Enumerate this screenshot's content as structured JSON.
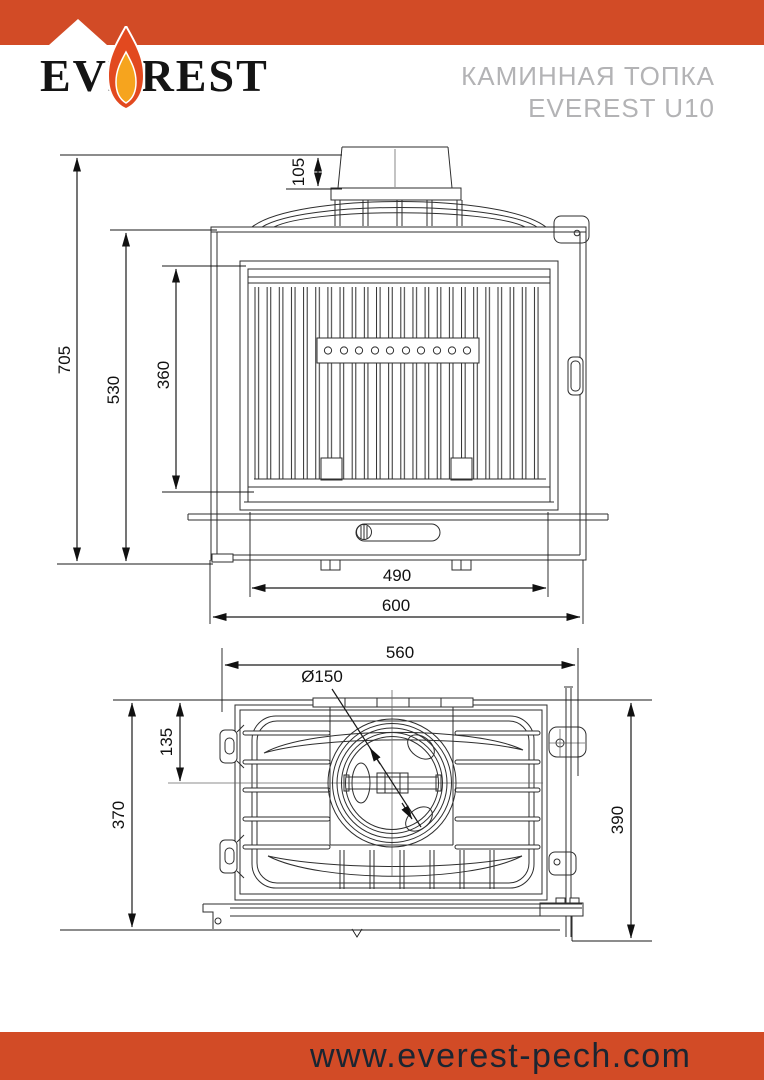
{
  "header": {
    "logo_text": "EVEREST",
    "product_title_line1": "КАМИННАЯ ТОПКА",
    "product_title_line2": "EVEREST U10"
  },
  "footer": {
    "website": "www.everest-pech.com"
  },
  "colors": {
    "accent_orange": "#d24b26",
    "drawing_line": "#2e2e2e",
    "title_gray": "#b3b3b5",
    "footer_text": "#1b2531",
    "flame_outer": "#e2491f",
    "flame_inner": "#f6a41e"
  },
  "front_view": {
    "dimensions": {
      "flue_collar_height": "105",
      "total_height": "705",
      "body_height": "530",
      "glass_height": "360",
      "inner_width": "490",
      "total_width": "600"
    }
  },
  "top_view": {
    "dimensions": {
      "total_width": "560",
      "flue_diameter": "Ø150",
      "flue_center_offset": "135",
      "body_depth": "370",
      "total_depth": "390"
    }
  }
}
